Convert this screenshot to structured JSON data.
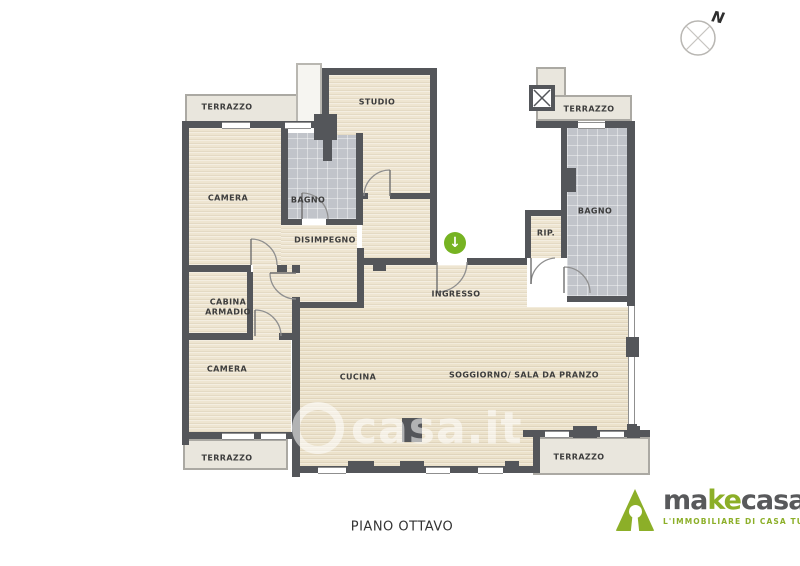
{
  "page": {
    "title": "PIANO OTTAVO"
  },
  "rooms": {
    "terrazzo_tl": "TERRAZZO",
    "camera_nord": "CAMERA",
    "bagno_ovest": "BAGNO",
    "studio": "STUDIO",
    "disimpegno": "DISIMPEGNO",
    "cabina_armadio": "CABINA ARMADIO",
    "camera_sud": "CAMERA",
    "cucina": "CUCINA",
    "ingresso": "INGRESSO",
    "rip": "RIP.",
    "bagno_est": "BAGNO",
    "terrazzo_tr": "TERRAZZO",
    "soggiorno": "SOGGIORNO/ SALA DA PRANZO",
    "terrazzo_bl": "TERRAZZO",
    "terrazzo_br": "TERRAZZO"
  },
  "compass": {
    "north_label": "N"
  },
  "entrance": {
    "arrow_glyph": "↓"
  },
  "watermark": {
    "text": "casa.it"
  },
  "brand": {
    "name_part_1": "ma",
    "name_part_2": "ke",
    "name_part_3": "casa",
    "registered_mark": "®",
    "tagline": "L'IMMOBILIARE DI CASA TUA"
  },
  "colors": {
    "wall": "#54565a",
    "wood_floor": "#eee5d1",
    "tile_floor": "#c1c4ca",
    "terrace": "#e9e6dd",
    "accent_green": "#76b322",
    "brand_green": "#8caf28"
  }
}
